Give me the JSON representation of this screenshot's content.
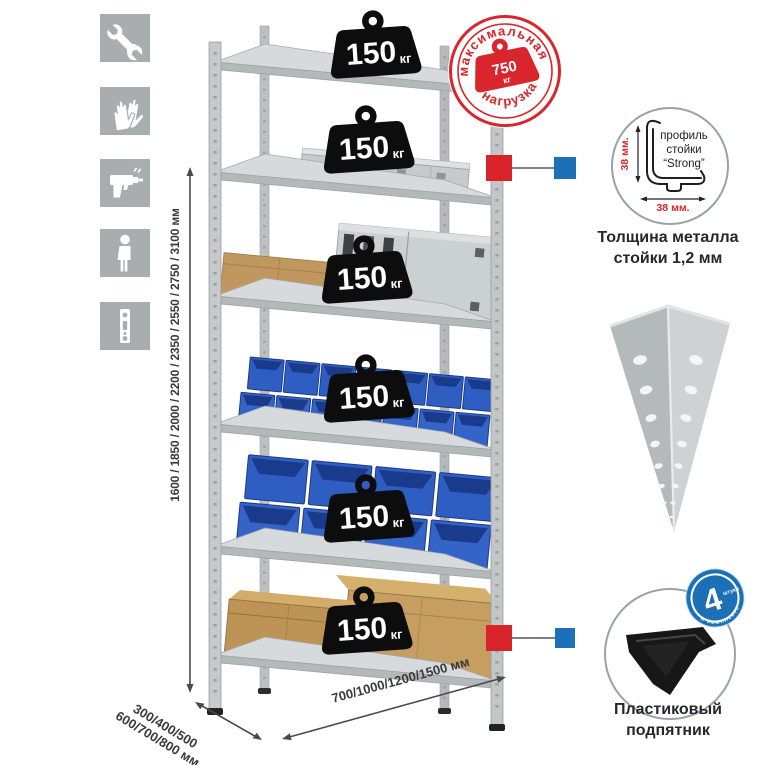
{
  "colors": {
    "accent_red": "#d8232a",
    "accent_blue": "#1c70b8",
    "stamp_red": "#d8262c",
    "bin_blue": "#2f5ec2",
    "icon_gray": "#a8adb0",
    "metal_light": "#d7dadc",
    "metal_mid": "#b3b8bb",
    "text_dark": "#26262e",
    "dim_text": "#3a3a3a"
  },
  "left_icons": {
    "items": [
      {
        "name": "wrench-icon"
      },
      {
        "name": "gloves-icon"
      },
      {
        "name": "drill-icon"
      },
      {
        "name": "person-icon"
      },
      {
        "name": "perforated-strip-icon"
      }
    ]
  },
  "height_dimension": {
    "label": "1600 / 1850 / 2000 / 2200 / 2350 / 2550 / 2750 / 3100 мм"
  },
  "depth_dimension": {
    "line1": "300/400/500",
    "line2": "600/700/800 мм"
  },
  "width_dimension": {
    "label": "700/1000/1200/1500 мм"
  },
  "shelf_badge": {
    "value": "150",
    "unit": "кг",
    "count": 6
  },
  "max_load_stamp": {
    "arc_top": "максимальная",
    "arc_bottom": "нагрузка",
    "value": "750",
    "unit": "кг"
  },
  "profile_detail": {
    "dim_vertical": "38 мм.",
    "dim_horizontal": "38 мм.",
    "label_line1": "профиль",
    "label_line2": "стойки",
    "label_line3": "“Strong”"
  },
  "thickness_caption": {
    "line1": "Толщина металла",
    "line2": "стойки 1,2 мм"
  },
  "kit_badge": {
    "value": "4",
    "small_word": "штуки",
    "arc": "в комплекте"
  },
  "foot_caption": {
    "line1": "Пластиковый",
    "line2": "подпятник"
  }
}
